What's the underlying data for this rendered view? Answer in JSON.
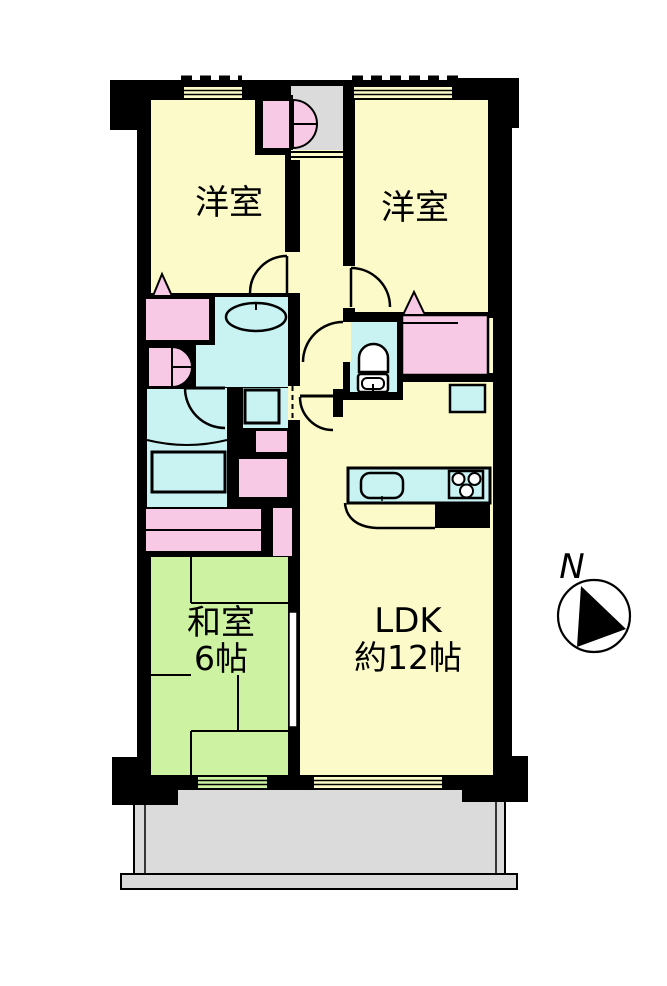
{
  "plan": {
    "rooms": {
      "bedroom_left": {
        "label": "洋室"
      },
      "bedroom_right": {
        "label": "洋室"
      },
      "japanese_room": {
        "label": "和室",
        "size": "6帖"
      },
      "ldk": {
        "label": "LDK",
        "size": "約12帖"
      }
    },
    "compass": {
      "north_label": "N"
    }
  },
  "colors": {
    "wall": "#000000",
    "room_yellow": "#FBFAC8",
    "tatami_green": "#CDF2A2",
    "wet_area_blue": "#C9F2F2",
    "closet_pink": "#F8C9E4",
    "balcony_gray": "#DBDBDB",
    "background": "#FFFFFF"
  }
}
